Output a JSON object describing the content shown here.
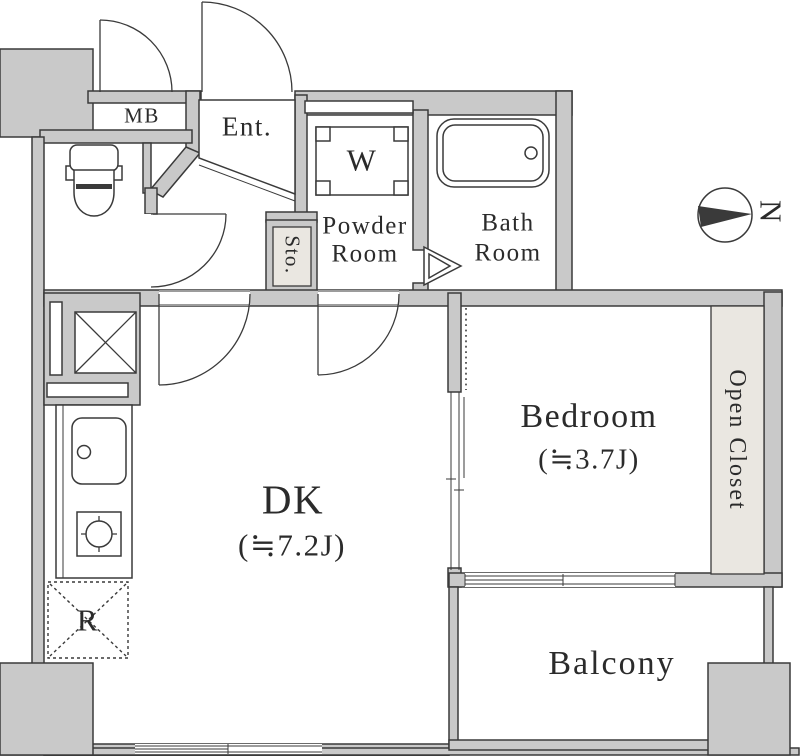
{
  "title": "apartment-floor-plan",
  "colors": {
    "wall": "#c9c9c9",
    "line": "#3a3a3a",
    "closet": "#eae7e1",
    "ink": "#2b2b2b",
    "paper": "#ffffff"
  },
  "rooms": {
    "dk": {
      "name": "DK",
      "size": "(≒7.2J)"
    },
    "bedroom": {
      "name": "Bedroom",
      "size": "(≒3.7J)"
    },
    "powder_room": {
      "line1": "Powder",
      "line2": "Room"
    },
    "bath_room": {
      "line1": "Bath",
      "line2": "Room"
    },
    "entrance": {
      "label": "Ent."
    },
    "storage": {
      "label": "Sto."
    },
    "open_closet": {
      "label": "Open Closet"
    },
    "balcony": {
      "label": "Balcony"
    }
  },
  "fixtures": {
    "meter_box": {
      "label": "MB"
    },
    "washer": {
      "label": "W"
    },
    "refrigerator": {
      "label": "R"
    }
  },
  "compass": {
    "north": "N"
  }
}
